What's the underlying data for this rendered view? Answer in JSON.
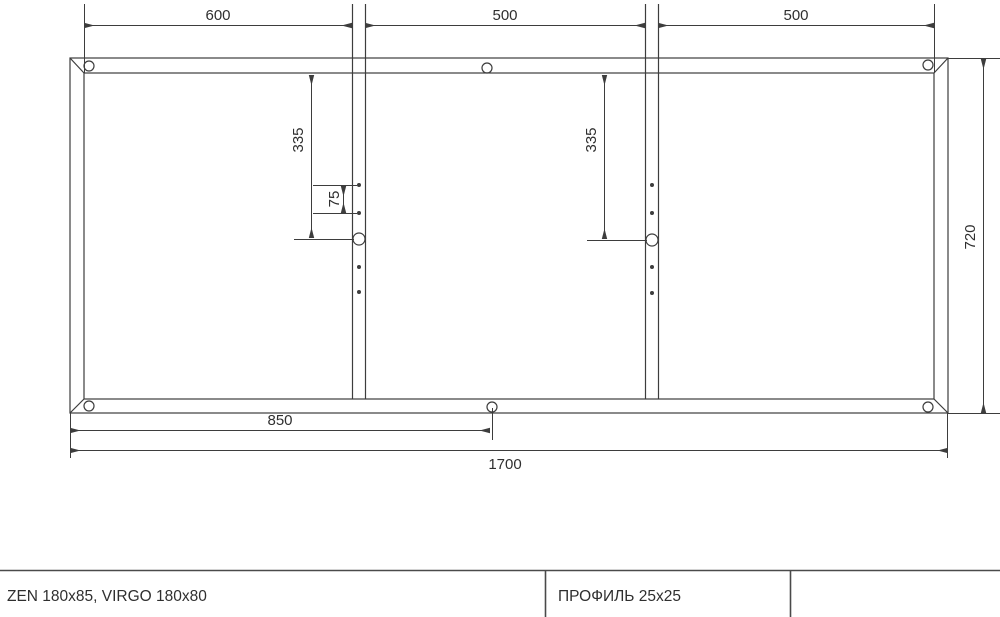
{
  "diagram": {
    "type": "technical-frame-drawing",
    "dimensions": {
      "top_section_1": "600",
      "top_section_2": "500",
      "top_section_3": "500",
      "left_spacing_335": "335",
      "hole_spacing_75": "75",
      "mid_spacing_335": "335",
      "frame_height": "720",
      "bottom_center_850": "850",
      "frame_width": "1700"
    },
    "title_block": {
      "models": "ZEN 180x85, VIRGO 180x80",
      "profile": "ПРОФИЛЬ 25x25"
    },
    "colors": {
      "line": "#3d3d3d",
      "text": "#2f2f2f",
      "background": "#ffffff"
    }
  }
}
